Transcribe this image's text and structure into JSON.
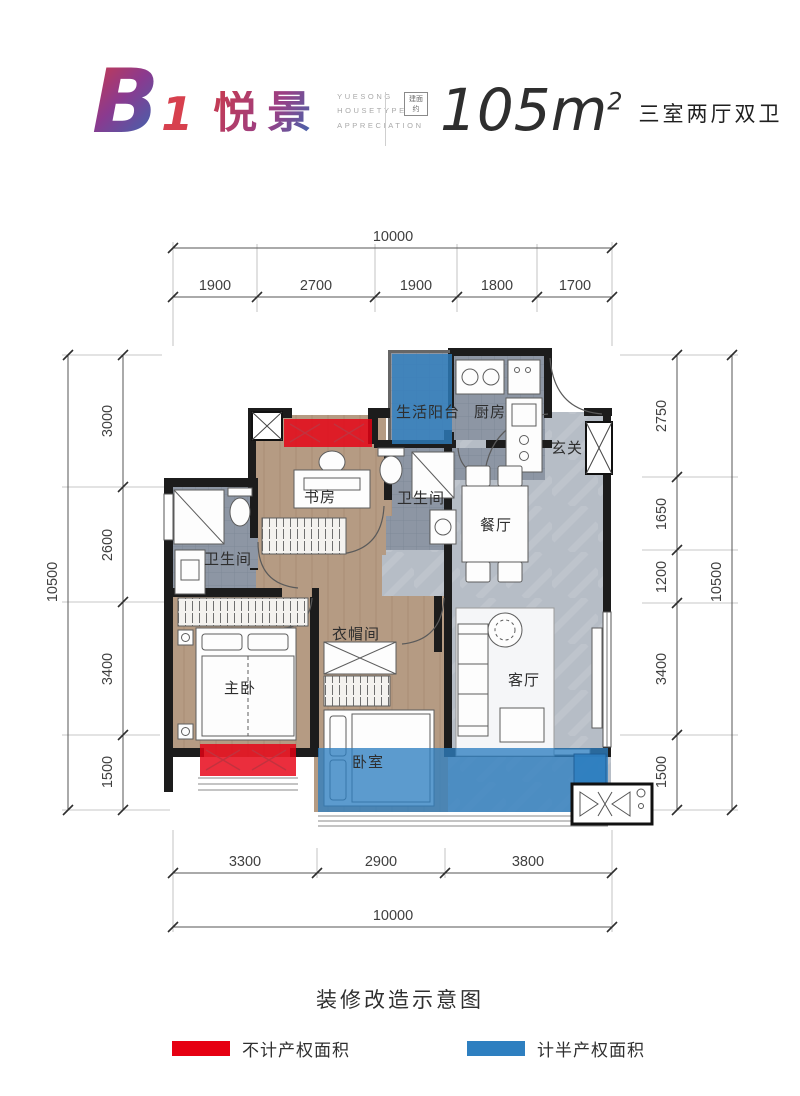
{
  "header": {
    "model": "B",
    "unit_no": "1",
    "name": "悦景",
    "subtitle_lines": [
      "YUESONG",
      "HOUSETYPE",
      "APPRECIATION"
    ],
    "seal": "建面约",
    "area_value": "105m",
    "area_sup": "2",
    "layout_type": "三室两厅双卫"
  },
  "rooms": {
    "balcony": "生活阳台",
    "kitchen": "厨房",
    "entry": "玄关",
    "bath_upper": "卫生间",
    "bath_left": "卫生间",
    "dining": "餐厅",
    "study": "书房",
    "master": "主卧",
    "closet": "衣帽间",
    "living": "客厅",
    "bedroom": "卧室"
  },
  "dimensions": {
    "top_total": "10000",
    "top_segments": [
      "1900",
      "2700",
      "1900",
      "1800",
      "1700"
    ],
    "left_total": "10500",
    "left_segments": [
      "3000",
      "2600",
      "3400",
      "1500"
    ],
    "right_total": "10500",
    "right_segments": [
      "2750",
      "1650",
      "1200",
      "3400",
      "1500"
    ],
    "bottom_total": "10000",
    "bottom_segments": [
      "3300",
      "2900",
      "3800"
    ]
  },
  "caption": "装修改造示意图",
  "legend": [
    {
      "label": "不计产权面积",
      "color": "#e60012"
    },
    {
      "label": "计半产权面积",
      "color": "#2e7fc0"
    }
  ]
}
